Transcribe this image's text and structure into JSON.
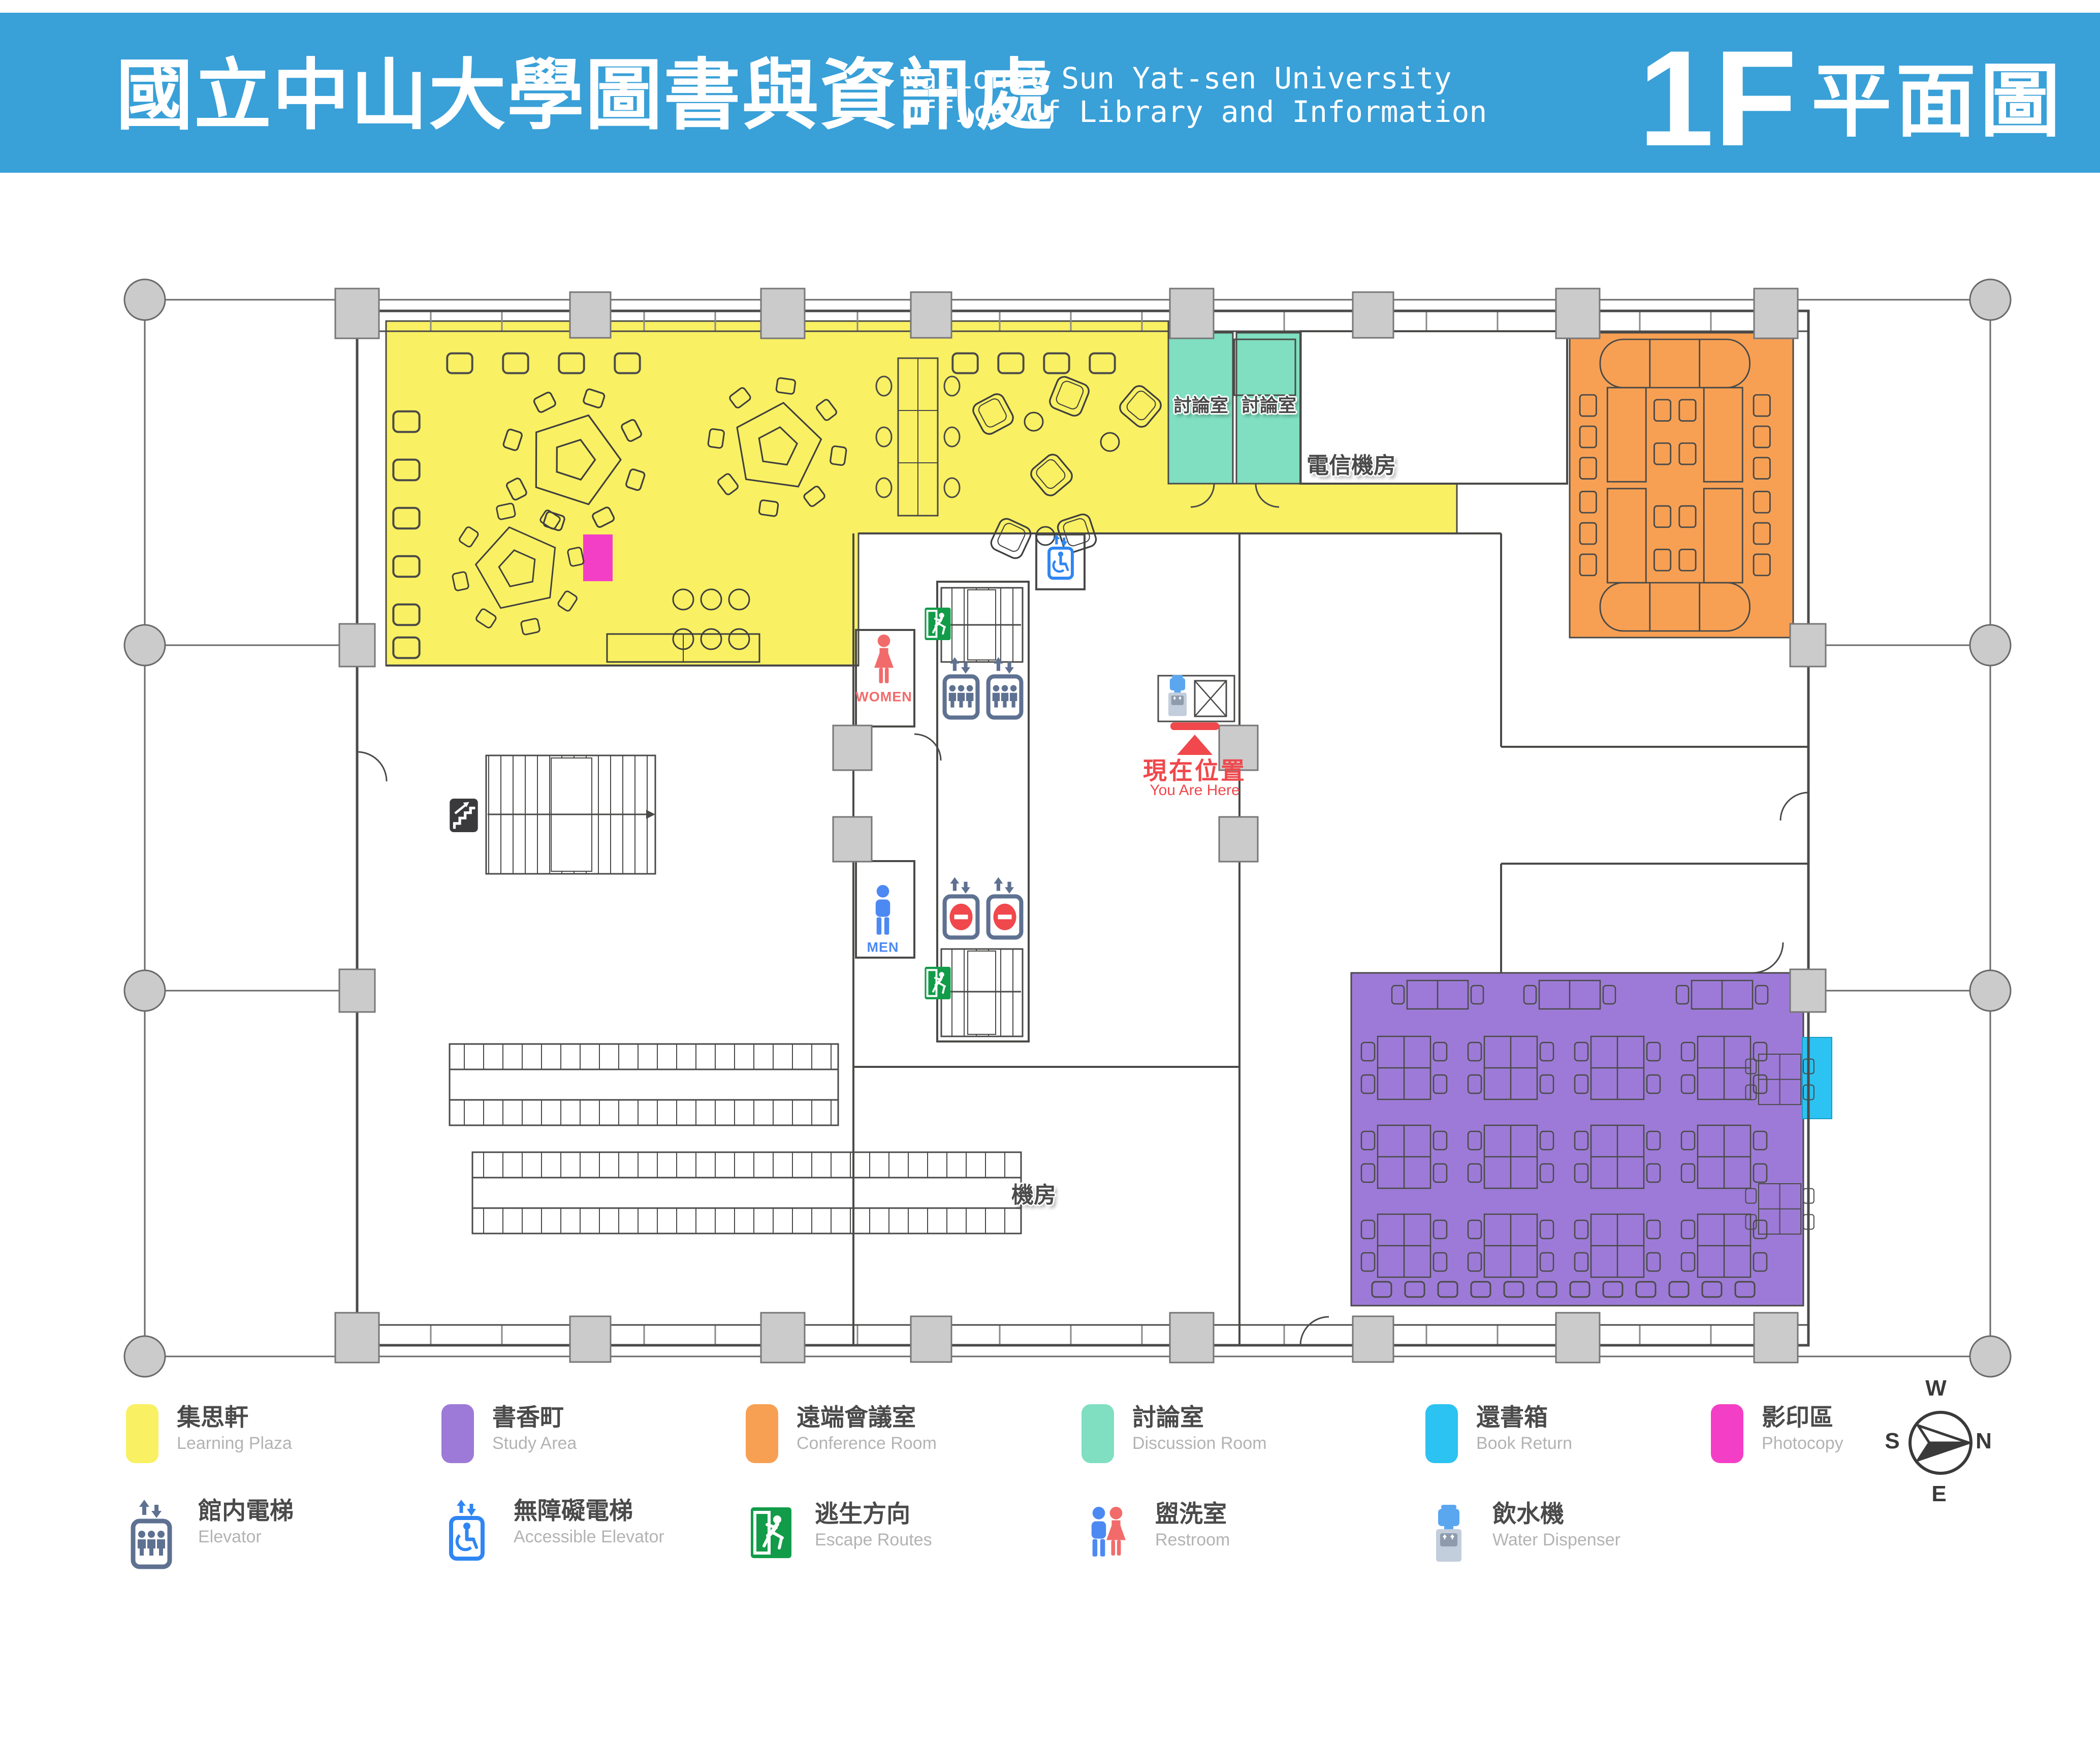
{
  "header": {
    "title_zh": "國立中山大學圖書與資訊處",
    "subtitle_en_line1": "National Sun Yat-sen University",
    "subtitle_en_line2": "Office of Library and Information",
    "floor_label": "1F",
    "floor_suffix_zh": "平面圖",
    "bar_color": "#39A0D8"
  },
  "plan": {
    "rooms": {
      "discussion_room_1": "討論室",
      "discussion_room_2": "討論室",
      "telecom_room": "電信機房",
      "machine_room": "機房"
    },
    "markers": {
      "women_label": "WOMEN",
      "men_label": "MEN",
      "you_are_here_zh": "現在位置",
      "you_are_here_en": "You Are Here"
    }
  },
  "legend": {
    "areas": [
      {
        "zh": "集思軒",
        "en": "Learning Plaza",
        "color": "#F9F063"
      },
      {
        "zh": "書香町",
        "en": "Study Area",
        "color": "#9D7AD7"
      },
      {
        "zh": "遠端會議室",
        "en": "Conference Room",
        "color": "#F7A054"
      },
      {
        "zh": "討論室",
        "en": "Discussion Room",
        "color": "#7FDFC0"
      },
      {
        "zh": "還書箱",
        "en": "Book Return",
        "color": "#2CC2F2"
      },
      {
        "zh": "影印區",
        "en": "Photocopy",
        "color": "#F33FC5"
      }
    ],
    "facilities": [
      {
        "zh": "館内電梯",
        "en": "Elevator",
        "icon": "elevator-icon"
      },
      {
        "zh": "無障礙電梯",
        "en": "Accessible Elevator",
        "icon": "accessible-elevator-icon"
      },
      {
        "zh": "逃生方向",
        "en": "Escape Routes",
        "icon": "escape-route-icon"
      },
      {
        "zh": "盥洗室",
        "en": "Restroom",
        "icon": "restroom-icon"
      },
      {
        "zh": "飲水機",
        "en": "Water Dispenser",
        "icon": "water-dispenser-icon"
      }
    ]
  },
  "compass": {
    "top": "W",
    "right": "N",
    "bottom": "E",
    "left": "S"
  },
  "status_colors": {
    "you_are_here": "#F0484C",
    "women": "#F26B6B",
    "men": "#4D89F2",
    "elevator": "#5E7191",
    "escape": "#129C49",
    "accessible": "#2F86F2",
    "walls": "#4A4A48"
  }
}
